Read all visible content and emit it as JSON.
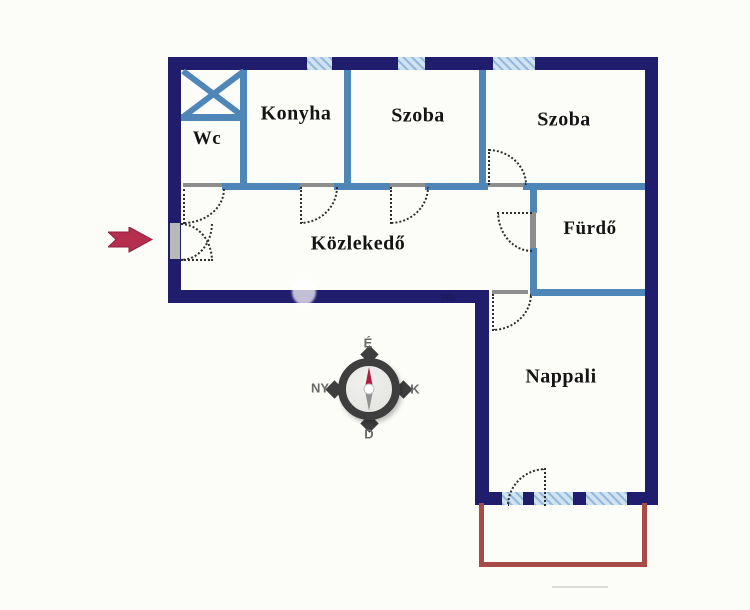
{
  "rooms": {
    "wc": {
      "label": "Wc"
    },
    "konyha": {
      "label": "Konyha"
    },
    "szoba1": {
      "label": "Szoba"
    },
    "szoba2": {
      "label": "Szoba"
    },
    "furdo": {
      "label": "Fürdő"
    },
    "kozlekedo": {
      "label": "Közlekedő"
    },
    "nappali": {
      "label": "Nappali"
    }
  },
  "compass": {
    "north_label": "É",
    "east_label": "K",
    "south_label": "D",
    "west_label": "NY"
  },
  "annotations": {
    "watermark_mark": "W®"
  },
  "colors": {
    "page_bg": "#fcfcf9",
    "outer_wall": "#211d6d",
    "inner_wall": "#4e86b8",
    "window_fill": "#cfe3f2",
    "window_hatch": "#96b9d9",
    "door_gray": "#8d8d8d",
    "door_arc": "#2e2e2e",
    "label_text": "#141414",
    "terrace_outline": "#a74b47",
    "entrance_arrow": "#b42e4e",
    "compass_ring": "#3e3e3e",
    "compass_label": "#6a6a6a",
    "needle_north": "#ad1e3f",
    "needle_south": "#909090"
  }
}
